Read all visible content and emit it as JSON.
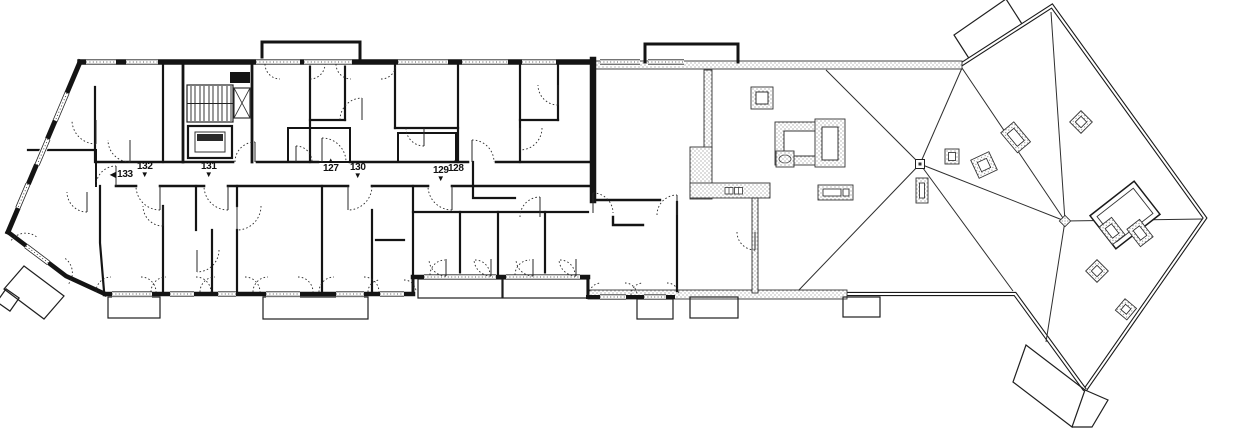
{
  "drawing": {
    "kind": "floor-plan-with-roof-plan",
    "style": "black-and-white architectural line drawing"
  },
  "colors": {
    "ink": "#141414",
    "paper": "#ffffff",
    "hatch": "#8a8a8a"
  },
  "corridor_labels": [
    {
      "number": "133",
      "arrow": "◀",
      "direction": "left"
    },
    {
      "number": "132",
      "arrow": "▼",
      "direction": "down"
    },
    {
      "number": "131",
      "arrow": "▼",
      "direction": "down"
    },
    {
      "number": "127",
      "arrow": "▲",
      "direction": "up"
    },
    {
      "number": "130",
      "arrow": "▼",
      "direction": "down"
    },
    {
      "number": "129",
      "arrow": "▼",
      "direction": "down"
    },
    {
      "number": "128",
      "arrow": "▲",
      "direction": "up"
    }
  ]
}
